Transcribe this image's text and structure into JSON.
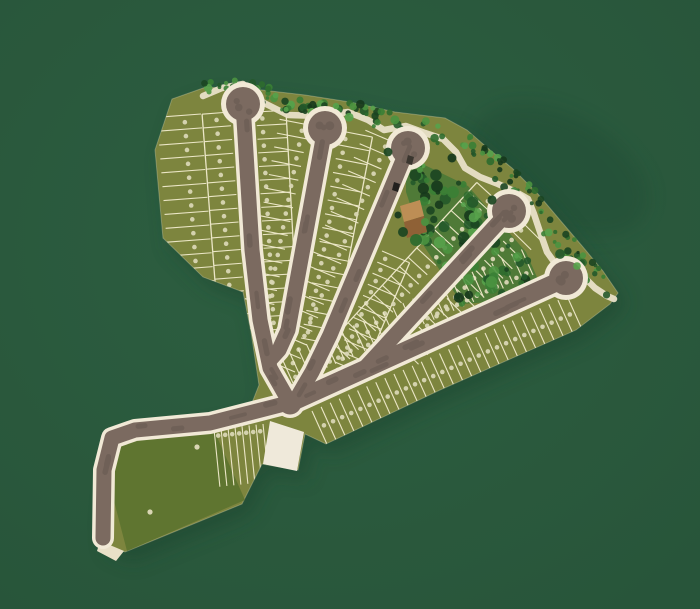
{
  "scene": {
    "label": "Subdivision master plan aerial site map",
    "type": "subdivision-site-plan",
    "seed": 1337
  },
  "canvas": {
    "w": 700,
    "h": 609
  },
  "palette": {
    "bg_center": "#2d5f41",
    "bg_edge": "#28553a",
    "site_shadow": "#1e452e",
    "shadow_blob": "#1f4730",
    "lot_base": "#7d853e",
    "field_green": "#5f7530",
    "amenity_green": "#4f7a37",
    "road_fill": "#7b6a60",
    "road_casing": "#f1e9d6",
    "path_cream": "#e9e0c8",
    "plaza_cream": "#efe9da",
    "lot_line": "#ebe6c6",
    "lot_dot": "#d9d6b4",
    "speckle": "#5f534b",
    "building_roof_light": "#bd8e55",
    "building_roof_dark": "#8f6136",
    "tree_colors": [
      "#16381c",
      "#1b4521",
      "#24592a",
      "#2d6b2e",
      "#3a7f35",
      "#4b9340",
      "#57a24b"
    ],
    "car_colors": [
      "#3a362f",
      "#22201e"
    ]
  },
  "site": {
    "outline": [
      [
        206,
        87
      ],
      [
        262,
        90
      ],
      [
        305,
        95
      ],
      [
        350,
        102
      ],
      [
        395,
        112
      ],
      [
        445,
        118
      ],
      [
        467,
        130
      ],
      [
        490,
        150
      ],
      [
        512,
        168
      ],
      [
        538,
        194
      ],
      [
        560,
        220
      ],
      [
        583,
        247
      ],
      [
        603,
        271
      ],
      [
        618,
        293
      ],
      [
        610,
        304
      ],
      [
        576,
        330
      ],
      [
        440,
        390
      ],
      [
        326,
        444
      ],
      [
        305,
        434
      ],
      [
        298,
        470
      ],
      [
        262,
        464
      ],
      [
        242,
        504
      ],
      [
        125,
        552
      ],
      [
        100,
        541
      ],
      [
        99,
        512
      ],
      [
        103,
        468
      ],
      [
        112,
        440
      ],
      [
        126,
        430
      ],
      [
        180,
        423
      ],
      [
        250,
        408
      ],
      [
        259,
        385
      ],
      [
        251,
        332
      ],
      [
        243,
        292
      ],
      [
        203,
        277
      ],
      [
        163,
        238
      ],
      [
        155,
        150
      ],
      [
        172,
        99
      ]
    ]
  },
  "areas": {
    "field": [
      [
        127,
        436
      ],
      [
        213,
        428
      ],
      [
        245,
        500
      ],
      [
        127,
        551
      ],
      [
        107,
        474
      ]
    ],
    "amenity": [
      [
        406,
        156
      ],
      [
        468,
        186
      ],
      [
        526,
        252
      ],
      [
        546,
        298
      ],
      [
        462,
        304
      ],
      [
        424,
        246
      ],
      [
        406,
        192
      ]
    ],
    "plaza": [
      [
        270,
        421
      ],
      [
        304,
        432
      ],
      [
        297,
        471
      ],
      [
        263,
        464
      ]
    ],
    "tip_pad": [
      [
        100,
        541
      ],
      [
        124,
        551
      ],
      [
        116,
        561
      ],
      [
        97,
        551
      ]
    ]
  },
  "perimeter_path": {
    "width": 6.5,
    "points": [
      [
        203,
        96
      ],
      [
        222,
        88
      ],
      [
        243,
        84
      ],
      [
        262,
        102
      ],
      [
        288,
        115
      ],
      [
        320,
        116
      ],
      [
        348,
        112
      ],
      [
        368,
        120
      ],
      [
        384,
        130
      ],
      [
        406,
        126
      ],
      [
        425,
        133
      ],
      [
        443,
        139
      ],
      [
        456,
        152
      ],
      [
        465,
        168
      ],
      [
        480,
        177
      ],
      [
        498,
        184
      ],
      [
        514,
        191
      ],
      [
        528,
        199
      ],
      [
        534,
        214
      ],
      [
        540,
        232
      ],
      [
        547,
        252
      ],
      [
        557,
        266
      ],
      [
        571,
        264
      ],
      [
        583,
        276
      ],
      [
        595,
        288
      ],
      [
        607,
        296
      ],
      [
        614,
        299
      ]
    ]
  },
  "streets": [
    {
      "id": "street-1",
      "pts": [
        [
          243,
          104
        ],
        [
          252,
          250
        ],
        [
          260,
          320
        ],
        [
          270,
          368
        ],
        [
          290,
          403
        ]
      ],
      "w": 15,
      "bulb": [
        243,
        104
      ]
    },
    {
      "id": "street-2",
      "pts": [
        [
          325,
          128
        ],
        [
          288,
          330
        ],
        [
          279,
          350
        ],
        [
          270,
          360
        ]
      ],
      "w": 15,
      "bulb": [
        325,
        128
      ]
    },
    {
      "id": "street-3",
      "pts": [
        [
          408,
          148
        ],
        [
          330,
          335
        ],
        [
          312,
          372
        ],
        [
          298,
          396
        ]
      ],
      "w": 15,
      "bulb": [
        408,
        148
      ]
    },
    {
      "id": "street-4",
      "pts": [
        [
          509,
          211
        ],
        [
          363,
          370
        ]
      ],
      "w": 15,
      "bulb": [
        509,
        211
      ]
    },
    {
      "id": "main-road",
      "pts": [
        [
          290,
          403
        ],
        [
          566,
          278
        ]
      ],
      "w": 18,
      "bulb": [
        566,
        278
      ]
    },
    {
      "id": "southwest-road",
      "pts": [
        [
          292,
          402
        ],
        [
          210,
          423
        ],
        [
          135,
          430
        ],
        [
          112,
          438
        ],
        [
          104,
          470
        ],
        [
          103,
          538
        ]
      ],
      "w": 15,
      "bulb": null
    }
  ],
  "junction": [
    290,
    403
  ],
  "bulb": {
    "fill_r": 17,
    "ring_r": 22
  },
  "lot_bands": [
    {
      "id": "block-west-outer",
      "a": [
        201,
        114
      ],
      "b": [
        218,
        336
      ],
      "len": 44,
      "side": -1,
      "count": 16,
      "dot": 0.38,
      "boundary": false
    },
    {
      "id": "block-west-inner",
      "a": [
        230,
        112
      ],
      "b": [
        247,
        332
      ],
      "len": 28,
      "side": -1,
      "count": 16,
      "dot": 0.5,
      "boundary": true
    },
    {
      "id": "m1-east-street1",
      "a": [
        256,
        112
      ],
      "b": [
        268,
        330
      ],
      "len": 30,
      "side": 1,
      "count": 16,
      "dot": 0.2,
      "boundary": true
    },
    {
      "id": "m1-west-street2",
      "a": [
        309,
        125
      ],
      "b": [
        269,
        332
      ],
      "len": 30,
      "side": -1,
      "count": 15,
      "dot": 0.2,
      "boundary": false
    },
    {
      "id": "m2-east-street2",
      "a": [
        341,
        131
      ],
      "b": [
        301,
        338
      ],
      "len": 32,
      "side": 1,
      "count": 15,
      "dot": 0.18,
      "boundary": true
    },
    {
      "id": "m2-west-street3",
      "a": [
        393,
        142
      ],
      "b": [
        295,
        372
      ],
      "len": 30,
      "side": -1,
      "count": 17,
      "dot": 0.18,
      "boundary": false
    },
    {
      "id": "m3-east-street3",
      "a": [
        382,
        251
      ],
      "b": [
        330,
        373
      ],
      "len": 30,
      "side": 1,
      "count": 11,
      "dot": 0.2,
      "boundary": true
    },
    {
      "id": "r1-nw-street4",
      "a": [
        496,
        200
      ],
      "b": [
        350,
        359
      ],
      "len": 26,
      "side": -1,
      "count": 17,
      "dot": 0.2,
      "boundary": true
    },
    {
      "id": "r2-se-street4",
      "a": [
        522,
        222
      ],
      "b": [
        400,
        346
      ],
      "len": 26,
      "side": 1,
      "count": 13,
      "dot": 0.2,
      "boundary": false
    },
    {
      "id": "r2-nw-main-road",
      "a": [
        533,
        275
      ],
      "b": [
        365,
        351
      ],
      "len": 28,
      "side": -1,
      "count": 17,
      "dot": 0.15,
      "boundary": false
    },
    {
      "id": "r3-north-main-road",
      "a": [
        293,
        383
      ],
      "b": [
        353,
        356
      ],
      "len": 30,
      "side": 1,
      "count": 7,
      "dot": 0.15,
      "boundary": false
    },
    {
      "id": "south-main-road",
      "a": [
        312,
        411
      ],
      "b": [
        567,
        296
      ],
      "len": 40,
      "side": -1,
      "count": 28,
      "dot": 0.45,
      "boundary": true
    },
    {
      "id": "south-sw-road",
      "a": [
        214,
        429
      ],
      "b": [
        263,
        424
      ],
      "len": 58,
      "side": -1,
      "count": 7,
      "dot": 0.12,
      "boundary": false
    }
  ],
  "forest_regions": [
    {
      "id": "forest-top",
      "count": 75,
      "rmin": 1.8,
      "rmax": 4.5,
      "poly": [
        [
          195,
          80
        ],
        [
          250,
          86
        ],
        [
          300,
          96
        ],
        [
          345,
          100
        ],
        [
          375,
          108
        ],
        [
          405,
          116
        ],
        [
          432,
          120
        ],
        [
          458,
          136
        ],
        [
          445,
          148
        ],
        [
          408,
          134
        ],
        [
          372,
          127
        ],
        [
          340,
          119
        ],
        [
          300,
          112
        ],
        [
          258,
          107
        ],
        [
          222,
          98
        ],
        [
          200,
          94
        ]
      ]
    },
    {
      "id": "forest-right",
      "count": 70,
      "rmin": 1.6,
      "rmax": 4.0,
      "poly": [
        [
          462,
          128
        ],
        [
          488,
          148
        ],
        [
          512,
          166
        ],
        [
          540,
          194
        ],
        [
          562,
          222
        ],
        [
          585,
          249
        ],
        [
          605,
          272
        ],
        [
          618,
          292
        ],
        [
          608,
          303
        ],
        [
          590,
          288
        ],
        [
          568,
          264
        ],
        [
          545,
          236
        ],
        [
          522,
          206
        ],
        [
          498,
          182
        ],
        [
          475,
          158
        ],
        [
          455,
          140
        ]
      ]
    },
    {
      "id": "forest-grove",
      "count": 95,
      "rmin": 2.2,
      "rmax": 6.0,
      "poly": [
        [
          406,
          156
        ],
        [
          468,
          186
        ],
        [
          526,
          252
        ],
        [
          546,
          298
        ],
        [
          462,
          304
        ],
        [
          424,
          246
        ],
        [
          406,
          192
        ]
      ]
    },
    {
      "id": "forest-behind-bulb1",
      "count": 12,
      "rmin": 1.8,
      "rmax": 3.6,
      "poly": [
        [
          216,
          76
        ],
        [
          272,
          80
        ],
        [
          268,
          94
        ],
        [
          214,
          92
        ]
      ]
    }
  ],
  "overhang_trees": [
    [
      388,
      152
    ],
    [
      420,
      170
    ],
    [
      452,
      158
    ],
    [
      492,
      200
    ],
    [
      560,
      254
    ],
    [
      577,
      266
    ],
    [
      300,
      100
    ],
    [
      336,
      106
    ]
  ],
  "building": {
    "roof_light": [
      [
        400,
        206
      ],
      [
        420,
        200
      ],
      [
        424,
        216
      ],
      [
        404,
        222
      ]
    ],
    "roof_dark": [
      [
        404,
        222
      ],
      [
        424,
        216
      ],
      [
        427,
        232
      ],
      [
        407,
        238
      ]
    ],
    "trees": [
      [
        403,
        232,
        5
      ],
      [
        416,
        240,
        6
      ],
      [
        425,
        222,
        4
      ],
      [
        398,
        215,
        3.5
      ]
    ]
  },
  "cars": [
    {
      "poly": [
        [
          408,
          155
        ],
        [
          414,
          157
        ],
        [
          412,
          165
        ],
        [
          406,
          163
        ]
      ],
      "color_index": 0
    },
    {
      "poly": [
        [
          394,
          182
        ],
        [
          400,
          184
        ],
        [
          398,
          192
        ],
        [
          392,
          190
        ]
      ],
      "color_index": 1
    }
  ],
  "field_dots": [
    [
      197,
      447
    ],
    [
      150,
      512
    ]
  ],
  "shadow_blob": {
    "cx": 560,
    "cy": 170,
    "rx": 95,
    "ry": 55,
    "rot": 28
  },
  "site_shadow_offset": [
    8,
    10
  ]
}
